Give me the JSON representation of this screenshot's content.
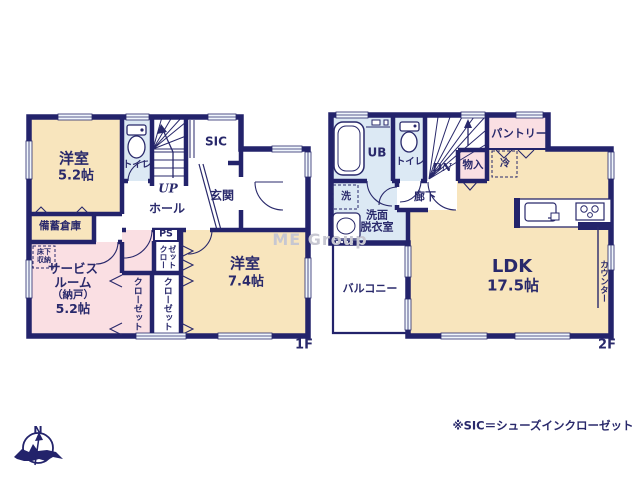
{
  "watermark": "ME Group",
  "compass": {
    "north": "N"
  },
  "note": "※SIC＝シューズインクローゼット",
  "f1": {
    "floor": "1F",
    "room1_name": "洋室",
    "room1_size": "5.2帖",
    "toilet": "トイレ",
    "up": "UP",
    "sic": "SIC",
    "genkan": "玄関",
    "hall": "ホール",
    "bichiku": "備蓄倉庫",
    "yukashita1": "床下",
    "yukashita2": "収納",
    "service1": "サービス",
    "service2": "ルーム",
    "service3": "（納戸）",
    "service4": "5.2帖",
    "ps": "PS",
    "closet_ps": "クローゼット",
    "closet_l": "クローゼット",
    "closet_r": "クローゼット",
    "room2_name": "洋室",
    "room2_size": "7.4帖"
  },
  "f2": {
    "floor": "2F",
    "ub": "UB",
    "toilet": "トイレ",
    "dn": "DN",
    "monoire": "物入",
    "pantry": "パントリー",
    "rei": "冷",
    "sen": "洗",
    "senmen1": "洗面",
    "senmen2": "脱衣室",
    "rouka": "廊下",
    "ldk_name": "LDK",
    "ldk_size": "17.5帖",
    "counter": "カウンター",
    "balcony": "バルコニー"
  },
  "colors": {
    "wall": "#23236b",
    "cream": "#f8e5bd",
    "pink": "#fadfe3",
    "blue": "#dce9f4",
    "text": "#29296b"
  }
}
